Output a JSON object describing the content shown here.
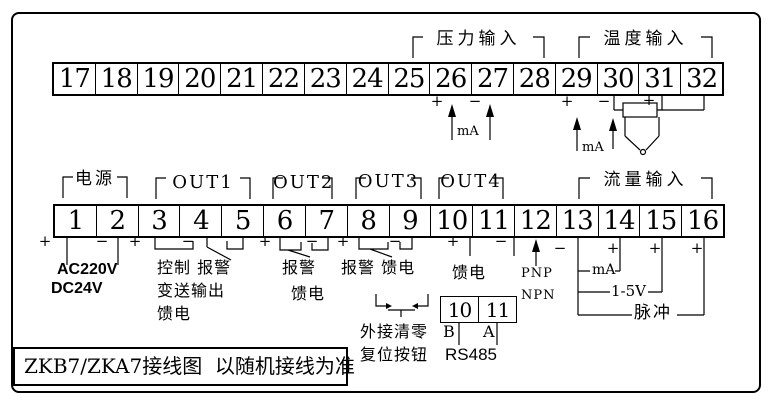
{
  "title": "ZKB7/ZKA7接线图  以随机接线为准",
  "top_terminals": [
    "17",
    "18",
    "19",
    "20",
    "21",
    "22",
    "23",
    "24",
    "25",
    "26",
    "27",
    "28",
    "29",
    "30",
    "31",
    "32"
  ],
  "bottom_terminals": [
    "1",
    "2",
    "3",
    "4",
    "5",
    "6",
    "7",
    "8",
    "9",
    "10",
    "11",
    "12",
    "13",
    "14",
    "15",
    "16"
  ],
  "groups": {
    "pressure": {
      "label": "压力输入",
      "plus": "+",
      "minus": "−",
      "unit": "mA"
    },
    "temperature": {
      "label": "温度输入",
      "plus_29": "+",
      "minus_30": "−",
      "plus_31": "+",
      "unit": "mA"
    },
    "power": {
      "label": "电源",
      "plus": "+",
      "minus": "−",
      "supply1": "AC220V",
      "supply2": "DC24V"
    },
    "out1": {
      "label": "OUT1",
      "plus": "+",
      "minus": "−",
      "desc1": "控制 报警",
      "desc2": "变送输出",
      "desc3": "馈电"
    },
    "out2": {
      "label": "OUT2",
      "plus": "+",
      "minus": "−",
      "desc1": "报警",
      "desc2": "馈电"
    },
    "out3": {
      "label": "OUT3",
      "plus": "+",
      "minus": "−",
      "desc1": "报警 馈电"
    },
    "out4": {
      "label": "OUT4",
      "plus": "+",
      "minus": "−",
      "desc1": "馈电"
    },
    "sensor_type": {
      "line1": "PNP",
      "line2": "NPN"
    },
    "flow": {
      "label": "流量输入",
      "minus_13": "−",
      "plus_14": "+",
      "plus_15": "+",
      "plus_16": "+",
      "mode1": "mA",
      "mode2": "1-5V",
      "mode3": "脉冲"
    },
    "reset_button": {
      "line1": "外接清零",
      "line2": "复位按钮"
    },
    "rs485": {
      "cell_left": "10",
      "cell_right": "11",
      "b": "B",
      "a": "A",
      "label": "RS485"
    }
  }
}
